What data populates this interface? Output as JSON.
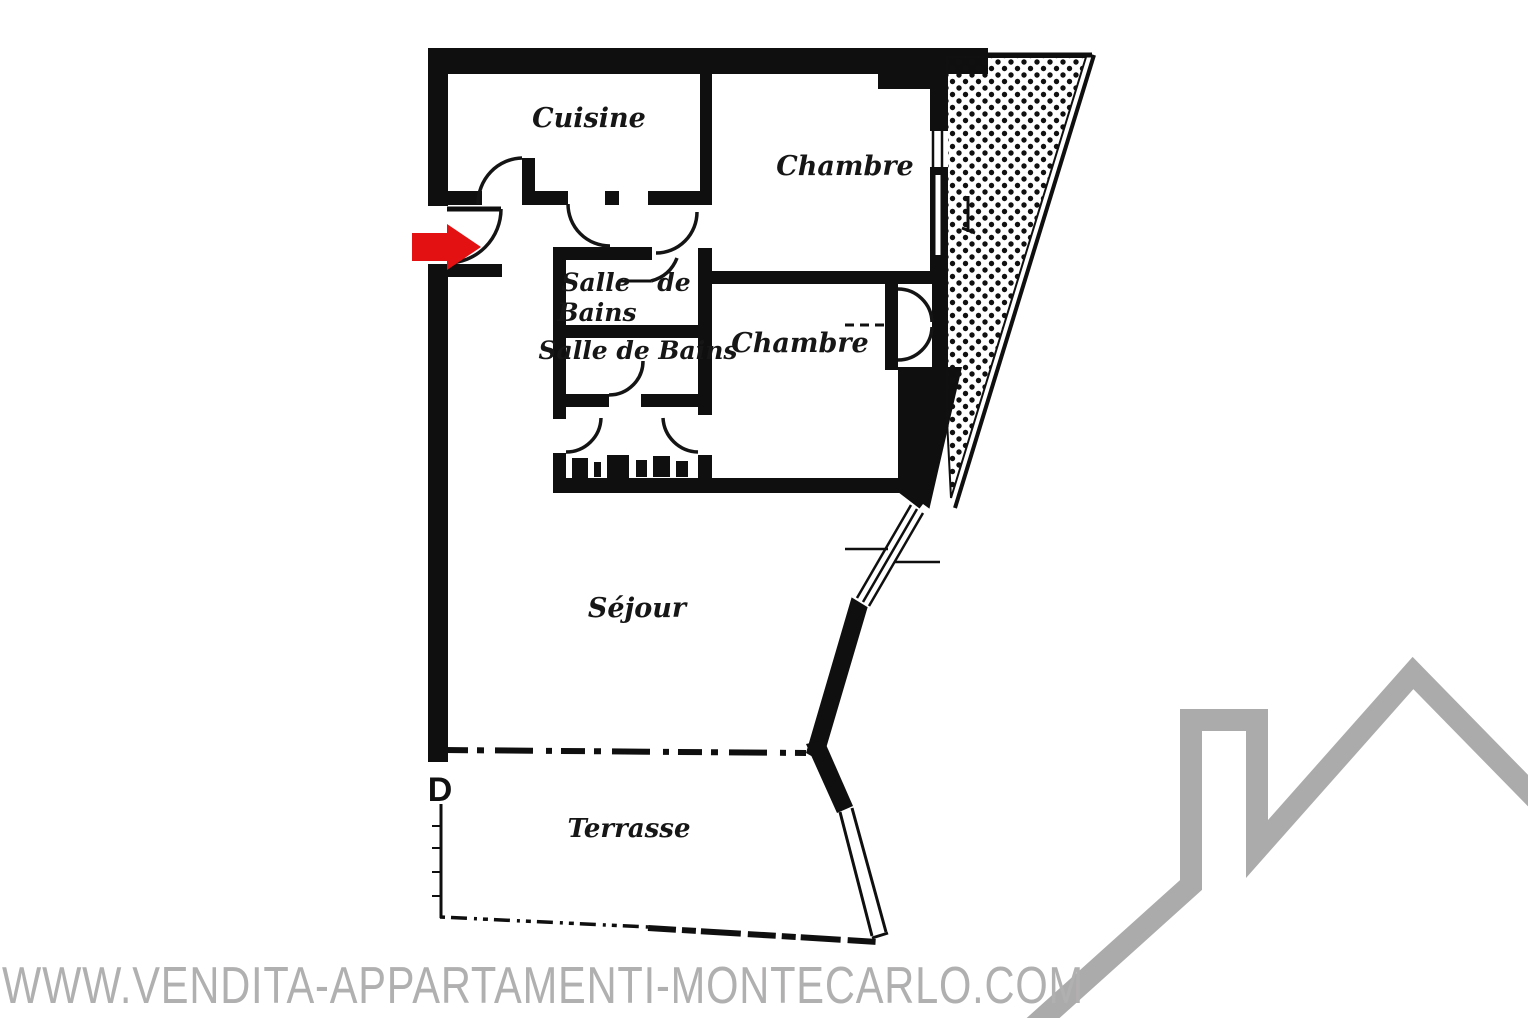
{
  "floorplan": {
    "labels": {
      "cuisine": "Cuisine",
      "chambre1": "Chambre",
      "bath1_salle": "Salle",
      "bath1_de": "de",
      "bath1_bains": "Bains",
      "bath2": "Salle de Bains",
      "chambre2": "Chambre",
      "sejour": "Séjour",
      "terrasse": "Terrasse",
      "door_marker": "D"
    },
    "colors": {
      "wall": "#0f0f0f",
      "entrance_arrow": "#e31111"
    }
  },
  "watermark": {
    "text": "WWW.VENDITA-APPARTAMENTI-MONTECARLO.COM",
    "color": "#b1b0b0"
  },
  "logo": {
    "icon": "house-roofline",
    "color": "#ababab"
  }
}
